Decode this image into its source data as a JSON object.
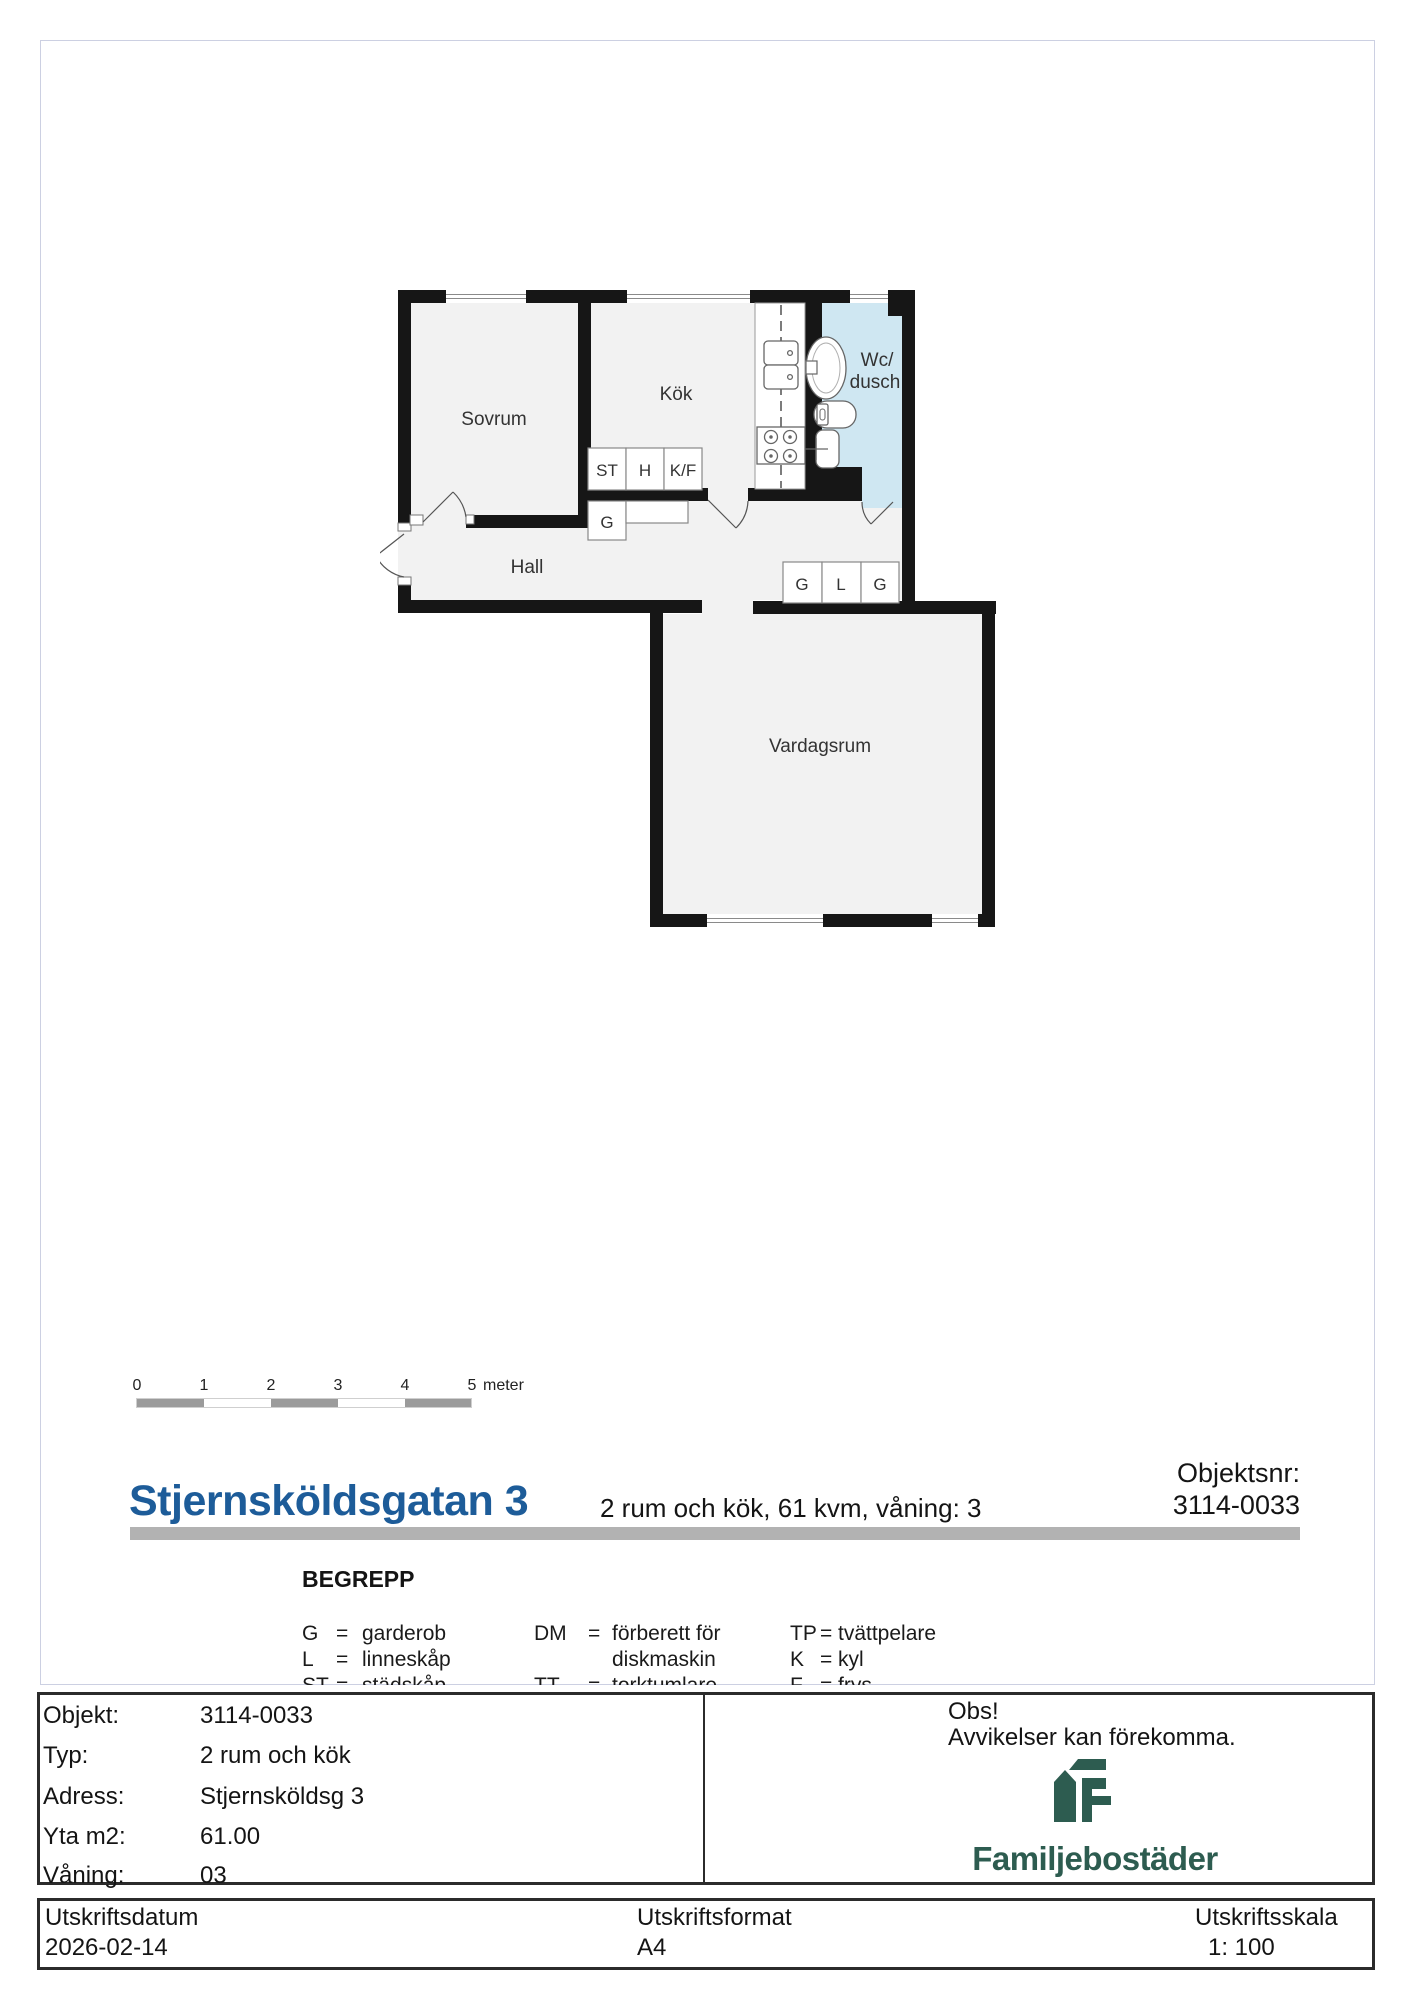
{
  "floor_plan": {
    "labels": {
      "sovrum": "Sovrum",
      "kok": "Kök",
      "wc_line1": "Wc/",
      "wc_line2": "dusch",
      "hall": "Hall",
      "vardagsrum": "Vardagsrum"
    },
    "closets": {
      "st": "ST",
      "h": "H",
      "kf": "K/F",
      "g_hall": "G",
      "g1": "G",
      "l": "L",
      "g2": "G"
    },
    "colors": {
      "wall": "#161616",
      "room_fill": "#f2f2f2",
      "bathroom_fill": "#cfe7f2",
      "fixture_stroke": "#666666"
    }
  },
  "scale_bar": {
    "ticks": [
      "0",
      "1",
      "2",
      "3",
      "4",
      "5"
    ],
    "unit": "meter",
    "bar_color": "#9b9b9b"
  },
  "title_block": {
    "street": "Stjernsköldsgatan 3",
    "subtitle": "2 rum och kök, 61 kvm, våning: 3",
    "objektsnr_label": "Objektsnr:",
    "objektsnr_value": "3114-0033",
    "accent_color": "#1d5c99",
    "rule_color": "#b2b2b2"
  },
  "legend": {
    "heading": "BEGREPP",
    "eq": "=",
    "col1": [
      {
        "abbr": "G",
        "term": "garderob"
      },
      {
        "abbr": "L",
        "term": "linneskåp"
      },
      {
        "abbr": "ST",
        "term": "städskåp"
      }
    ],
    "col2": [
      {
        "abbr": "DM",
        "term": "förberett för"
      },
      {
        "abbr": "",
        "term": "diskmaskin"
      },
      {
        "abbr": "TT",
        "term": "torktumlare"
      }
    ],
    "col3": [
      {
        "abbr": "TP",
        "term": "tvättpelare"
      },
      {
        "abbr": "K",
        "term": "kyl"
      },
      {
        "abbr": "F",
        "term": "frys"
      }
    ]
  },
  "info_table": {
    "rows": [
      {
        "label": "Objekt:",
        "value": "3114-0033"
      },
      {
        "label": "Typ:",
        "value": "2 rum och kök"
      },
      {
        "label": "Adress:",
        "value": "Stjernsköldsg 3"
      },
      {
        "label": "Yta m2:",
        "value": "61.00"
      },
      {
        "label": "Våning:",
        "value": "03"
      }
    ]
  },
  "notice": {
    "line1": "Obs!",
    "line2": "Avvikelser kan förekomma."
  },
  "brand": {
    "name": "Familjebostäder",
    "color": "#2d5c50"
  },
  "print_footer": {
    "columns": [
      {
        "label": "Utskriftsdatum",
        "value": "2026-02-14"
      },
      {
        "label": "Utskriftsformat",
        "value": "A4"
      },
      {
        "label": "Utskriftsskala",
        "value": "1: 100"
      }
    ]
  }
}
